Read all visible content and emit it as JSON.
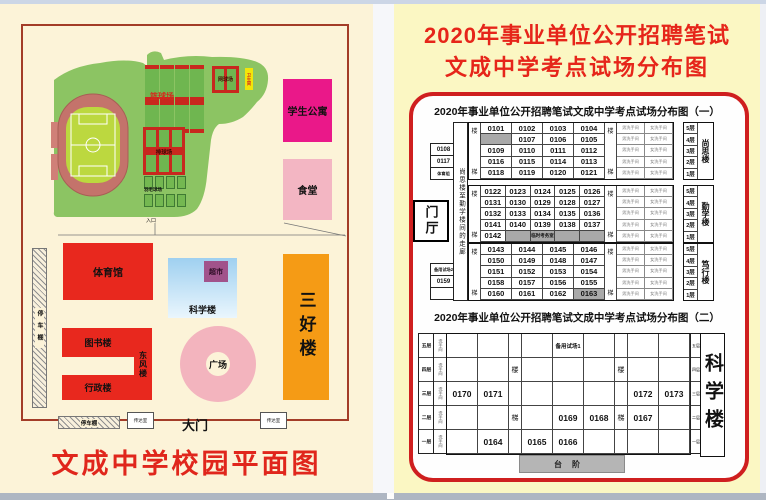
{
  "left_page": {
    "map_title": "文成中学校园平面图",
    "sports": {
      "basketball": "篮球场",
      "tennis": "网球场",
      "volleyball": "排球场",
      "badminton": "羽毛球场",
      "kiosk": "卫生间",
      "entrance": "入口"
    },
    "buildings": {
      "dorm": "学生公寓",
      "canteen": "食堂",
      "gym": "体育馆",
      "science": "科学楼",
      "market": "超市",
      "library": "图书楼",
      "dongfeng": "东风楼",
      "admin": "行政楼",
      "sanhao": "三好楼",
      "plaza": "广场",
      "gate": "大门",
      "parking_left": "停车棚",
      "parking_bottom": "停车棚",
      "gatehouse1": "传达室",
      "gatehouse2": "传达室"
    }
  },
  "right_page": {
    "header_line1": "2020年事业单位公开招聘笔试",
    "header_line2": "文成中学考点试场分布图",
    "chart1": {
      "title": "2020年事业单位公开招聘笔试文成中学考点试场分布图（一）",
      "corridor": "尚思楼至勤学楼间的走廊",
      "lobby": "门厅",
      "stair_top": "楼",
      "stair_bottom": "梯",
      "wc_male": "男洗手间",
      "wc_female": "女洗手间",
      "floor_labels": [
        "5层",
        "4层",
        "3层",
        "2层",
        "1层"
      ],
      "left_boxes_top": [
        "0108",
        "0117",
        "体育组"
      ],
      "left_boxes_bottom": [
        "备用试场2",
        "0159",
        ""
      ],
      "groups": [
        {
          "building": "尚思楼",
          "rows": [
            [
              "0101",
              "0102",
              "0103",
              "0104"
            ],
            [
              {
                "text": "",
                "gray": true
              },
              "0107",
              "0106",
              "0105"
            ],
            [
              "0109",
              "0110",
              "0111",
              "0112"
            ],
            [
              "0116",
              "0115",
              "0114",
              "0113"
            ],
            [
              "0118",
              "0119",
              "0120",
              "0121"
            ]
          ]
        },
        {
          "building": "勤学楼",
          "rows": [
            [
              "0122",
              "0123",
              "0124",
              "0125",
              "0126"
            ],
            [
              "0131",
              "0130",
              "0129",
              "0128",
              "0127"
            ],
            [
              "0132",
              "0133",
              "0134",
              "0135",
              "0136"
            ],
            [
              "0141",
              "0140",
              "0139",
              "0138",
              "0137"
            ],
            [
              "0142",
              {
                "text": "",
                "gray": true
              },
              {
                "text": "临时考务室",
                "gray": true
              },
              {
                "text": "",
                "gray": true
              },
              {
                "text": "",
                "gray": true
              }
            ]
          ]
        },
        {
          "building": "笃行楼",
          "rows": [
            [
              "0143",
              "0144",
              "0145",
              "0146"
            ],
            [
              "0150",
              "0149",
              "0148",
              "0147"
            ],
            [
              "0151",
              "0152",
              "0153",
              "0154"
            ],
            [
              "0158",
              "0157",
              "0156",
              "0155"
            ],
            [
              "0160",
              "0161",
              "0162",
              {
                "text": "0163",
                "gray": true
              }
            ]
          ]
        }
      ]
    },
    "chart2": {
      "title": "2020年事业单位公开招聘笔试文成中学考点试场分布图（二）",
      "wc": "洗手间",
      "building": "科学楼",
      "steps": "台阶",
      "floor_labels": [
        "五层",
        "四层",
        "三层",
        "二层",
        "一层"
      ],
      "rows": [
        [
          "",
          "",
          "",
          "",
          "备用试场1",
          "",
          "",
          "",
          ""
        ],
        [
          "",
          "",
          "楼",
          "",
          "",
          "",
          "楼",
          "",
          ""
        ],
        [
          "0170",
          "0171",
          "",
          "",
          "",
          "",
          "",
          "0172",
          "0173"
        ],
        [
          "",
          "",
          "梯",
          "",
          "0169",
          "0168",
          "梯",
          "0167",
          ""
        ],
        [
          "",
          "0164",
          "",
          "0165",
          "0166",
          "",
          "",
          "",
          ""
        ]
      ]
    }
  }
}
